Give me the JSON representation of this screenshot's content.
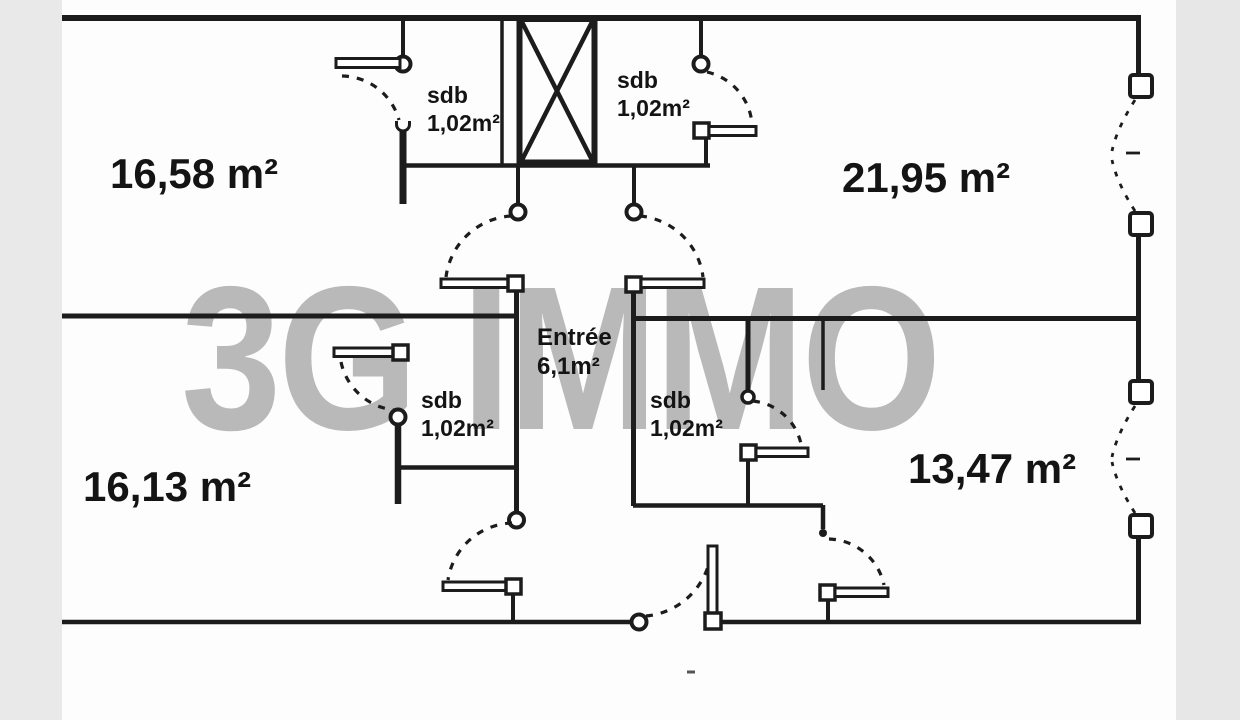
{
  "watermark": {
    "text": "3G IMMO"
  },
  "rooms": {
    "top_left": {
      "area": "16,58 m²"
    },
    "top_right": {
      "area": "21,95 m²"
    },
    "bottom_left": {
      "area": "16,13 m²"
    },
    "bottom_right": {
      "area": "13,47 m²"
    }
  },
  "bathrooms": {
    "top_left": {
      "name": "sdb",
      "area": "1,02m²"
    },
    "top_right": {
      "name": "sdb",
      "area": "1,02m²"
    },
    "bottom_left": {
      "name": "sdb",
      "area": "1,02m²"
    },
    "bottom_right": {
      "name": "sdb",
      "area": "1,02m²"
    }
  },
  "entry": {
    "name": "Entrée",
    "area": "6,1m²"
  },
  "colors": {
    "wall": "#1c1c1c",
    "watermark": "#b9b9b9",
    "scan_edge": "#e8e8e8",
    "background": "#fdfdfd"
  }
}
